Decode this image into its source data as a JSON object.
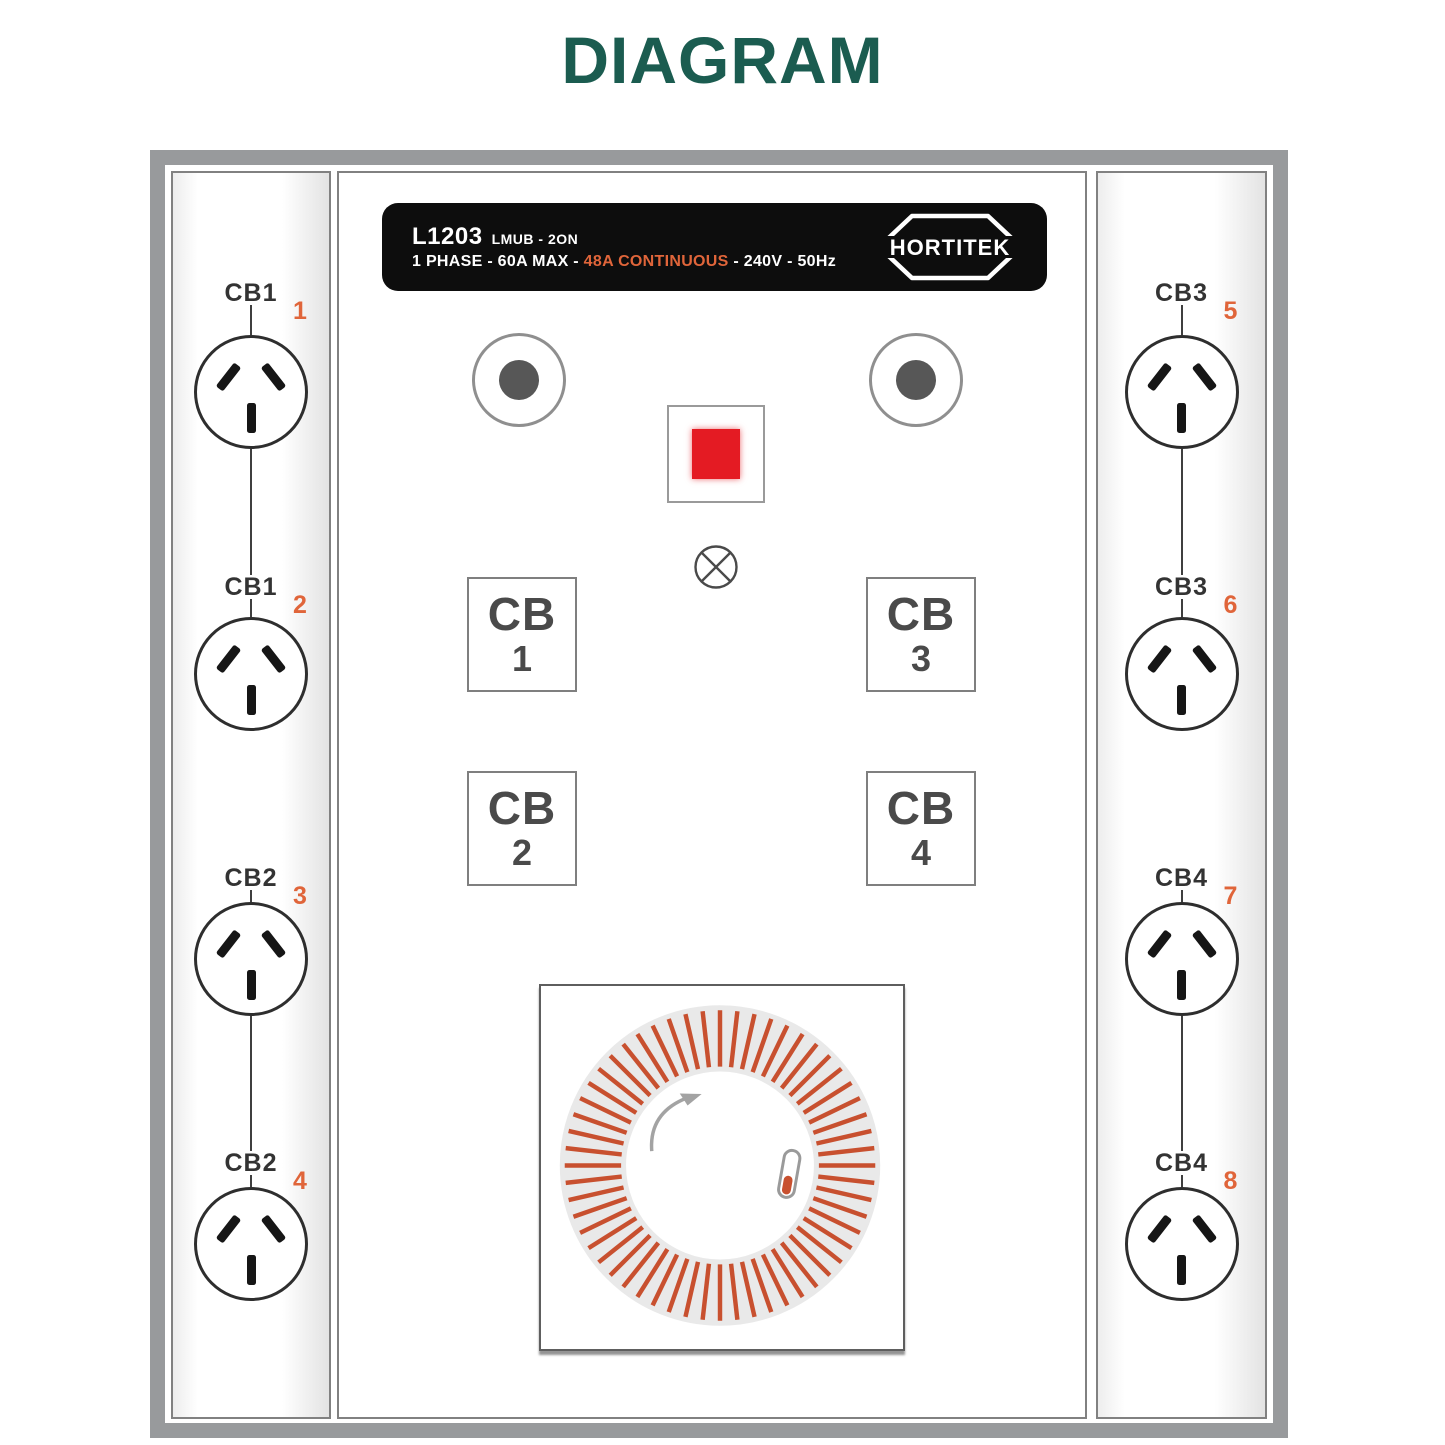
{
  "page": {
    "title": "DIAGRAM"
  },
  "colors": {
    "title-green": "#1b5c50",
    "accent-orange": "#e0653a",
    "button-red": "#e41b23",
    "tick-red": "#c8502f",
    "ring-gray": "#e9e9e9",
    "frame-gray": "#989a9c"
  },
  "device_label": {
    "model": "L1203",
    "variant": "LMUB - 2ON",
    "spec_prefix": "1 PHASE - 60A MAX - ",
    "spec_highlight": "48A CONTINUOUS",
    "spec_suffix": " - 240V - 50Hz",
    "brand": "HORTITEK"
  },
  "breakers": [
    {
      "label": "CB",
      "number": "1"
    },
    {
      "label": "CB",
      "number": "3"
    },
    {
      "label": "CB",
      "number": "2"
    },
    {
      "label": "CB",
      "number": "4"
    }
  ],
  "outlets": {
    "left": [
      {
        "cb": "CB1",
        "number": "1"
      },
      {
        "cb": "CB1",
        "number": "2"
      },
      {
        "cb": "CB2",
        "number": "3"
      },
      {
        "cb": "CB2",
        "number": "4"
      }
    ],
    "right": [
      {
        "cb": "CB3",
        "number": "5"
      },
      {
        "cb": "CB3",
        "number": "6"
      },
      {
        "cb": "CB4",
        "number": "7"
      },
      {
        "cb": "CB4",
        "number": "8"
      }
    ]
  },
  "timer": {
    "tick_count": 56
  }
}
